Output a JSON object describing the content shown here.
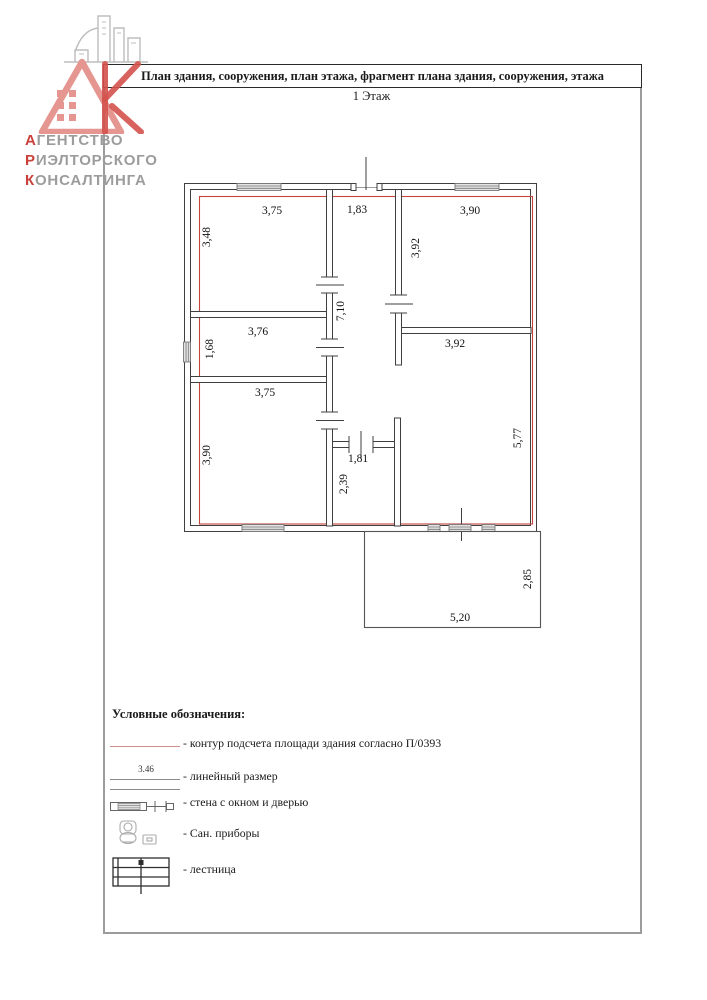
{
  "header": {
    "title": "План здания, сооружения, план этажа, фрагмент плана здания, сооружения, этажа",
    "floor": "1 Этаж"
  },
  "logo": {
    "lines": [
      {
        "lead": "А",
        "rest": "ГЕНТСТВО"
      },
      {
        "lead": "Р",
        "rest": "ИЭЛТОРСКОГО"
      },
      {
        "lead": "К",
        "rest": "ОНСАЛТИНГА"
      }
    ]
  },
  "plan": {
    "dimensions": [
      {
        "value": "3,75",
        "orientation": "horizontal"
      },
      {
        "value": "1,83",
        "orientation": "horizontal"
      },
      {
        "value": "3,90",
        "orientation": "horizontal"
      },
      {
        "value": "3,48",
        "orientation": "vertical"
      },
      {
        "value": "3,92",
        "orientation": "vertical"
      },
      {
        "value": "7,10",
        "orientation": "vertical"
      },
      {
        "value": "1,68",
        "orientation": "vertical"
      },
      {
        "value": "3,76",
        "orientation": "horizontal"
      },
      {
        "value": "3,92",
        "orientation": "horizontal"
      },
      {
        "value": "3,75",
        "orientation": "horizontal"
      },
      {
        "value": "3,90",
        "orientation": "vertical"
      },
      {
        "value": "1,81",
        "orientation": "horizontal"
      },
      {
        "value": "2,39",
        "orientation": "vertical"
      },
      {
        "value": "5,77",
        "orientation": "vertical"
      },
      {
        "value": "2,85",
        "orientation": "vertical"
      },
      {
        "value": "5,20",
        "orientation": "horizontal"
      }
    ]
  },
  "legend": {
    "heading": "Условные обозначения:",
    "sample_value": "3.46",
    "items": [
      {
        "symbol": "contour-line",
        "label": "- контур подсчета площади здания согласно П/0393"
      },
      {
        "symbol": "linear-size",
        "label": "- линейный размер"
      },
      {
        "symbol": "wall-window-door",
        "label": "- стена с окном и дверью"
      },
      {
        "symbol": "sanitary",
        "label": "- Сан. приборы"
      },
      {
        "symbol": "stairs",
        "label": "- лестница"
      }
    ]
  },
  "colors": {
    "contour_red": "#c4433b",
    "legend_contour": "#cf8f8c",
    "wall_gray": "#3f3f3f",
    "logo_pink": "#e59690",
    "logo_red": "#d4524c"
  }
}
